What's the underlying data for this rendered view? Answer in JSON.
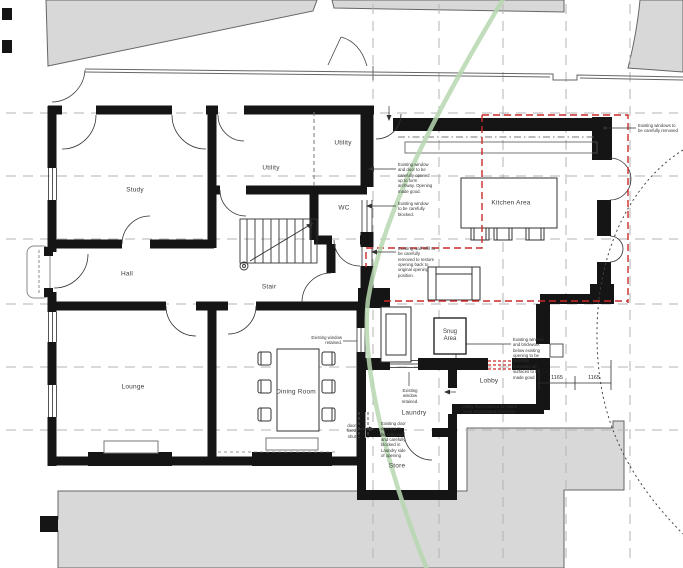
{
  "rooms": {
    "study": "Study",
    "utility_main": "Utility",
    "utility_small": "Utility",
    "wc": "WC",
    "stair": "Stair",
    "hall": "Hall",
    "lounge": "Lounge",
    "dining": "Dining Room",
    "kitchen": "Kitchen Area",
    "snug": "Snug Area",
    "lobby": "Lobby",
    "laundry": "Laundry",
    "store": "Store"
  },
  "dimensions": {
    "left_segment": "1165",
    "right_segment": "1165"
  },
  "annotations": {
    "archway": "Existing window and door to be carefully opened up to form archway. Opening made good.",
    "window_blocked": "Existing window to be carefully blocked.",
    "wall_infill": "Existing wall infill to be carefully removed to restore opening back to original opening position.",
    "windows_removed": "Existing windows to be carefully removed",
    "window_brickwork": "Existing window and brickwork below existing opening to be carefully removed, all surfaces to be made good",
    "window_retained_laundry": "Existing window retained.",
    "window_retained_left": "Existing window retained.",
    "lobby_floor": "Lobby floor lowered to match level of proposed extension",
    "door_blocked": "Existing door opening to be retained and carefully blocked in Laundry side of opening",
    "door_fixed": "door fixed shut"
  },
  "colors": {
    "wall": "#151515",
    "neighbour_fill": "#d8d8d8",
    "grid": "#b3b3b3",
    "tree_protection_green": "#b6d7af",
    "proposal_red": "#cc2a2a"
  }
}
